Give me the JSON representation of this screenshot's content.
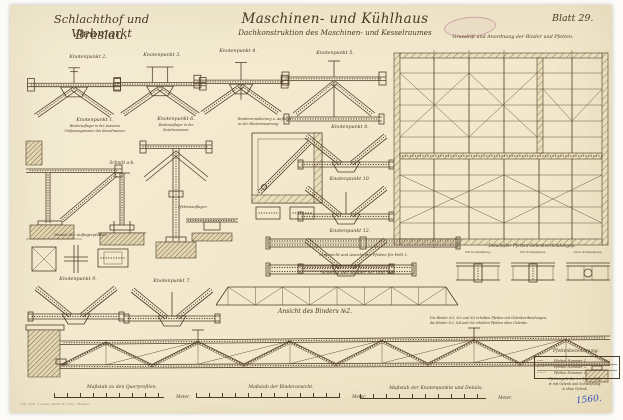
{
  "sheet": {
    "project_line1": "Schlachthof und Viehmarkt",
    "project_line2": "Breslau.",
    "title_line1": "Maschinen- und Kühlhaus",
    "subtitle": "Dachkonstruktion des Maschinen- und Kesselraumes",
    "blatt_label": "Blatt 29.",
    "archive_number": "1560.",
    "printer_note": "Lith. Anst. v. Grass, Barth & Comp., Breslau.",
    "ink_color": "#4f3c27",
    "paper_color": "#f2e8cc"
  },
  "plan": {
    "title": "Grundriß und Anordnung der Binder und Pfetten."
  },
  "details": {
    "k1": "Knotenpunkt 1.",
    "k1_sub1": "Binderauflager in der äusseren",
    "k1_sub2": "Umfassungsmauer des Kesselraumes.",
    "k2": "Knotenpunkt 2.",
    "k3": "Knotenpunkt 3.",
    "k4": "Knotenpunkt 4.",
    "k5": "Knotenpunkt 5.",
    "k6": "Knotenpunkt 6.",
    "k6_sub1": "Binderauflager in der",
    "k6_sub2": "Zwischenmauer.",
    "k7": "Knotenpunkt 7.",
    "k8": "Knotenpunkt 8.",
    "k9": "Knotenpunkt 9.",
    "k10": "Knotenpunkt 10.",
    "k12": "Knotenpunkt 12.",
    "schnitt_ab": "Schnitt a-b.",
    "pfettenauflager": "Pfettenauflager:",
    "verankerung1": "Binderverankerung u. Auflager",
    "verankerung2": "in der Hintermauerung:",
    "auflagerplatten": "Details der Auflagerplatten.",
    "untersicht_pfette": "Untersicht und Ansicht der Pfetten für Feld 2.",
    "gelenke_title": "Details der Pfetten-Gelenkverbindungen:",
    "gelenk1": "mit Schweißung.",
    "gelenk2": "mit Schweißung.",
    "gelenk3": "ohne Schweißung.",
    "schema_title": "Schema der Binder №1 und №2.",
    "ansicht_title": "Ansicht des Binders №2."
  },
  "notes": {
    "binder_note1": "Die Binder №1, №3 und №5 erhalten Pfetten mit Gelenkverbindungen,",
    "binder_note2": "die Binder №2, №4 und №6 erhalten Pfetten ohne Gelenke."
  },
  "legend": {
    "title": "Pfettenbezeichnung:",
    "rows": [
      {
        "sym": "───",
        "label": "Pfetten Nummer 1."
      },
      {
        "sym": "─ · ─",
        "label": "Pfetten Nummer 2."
      },
      {
        "sym": "─ ─ ─",
        "label": "Pfetten Nummer 3."
      }
    ],
    "note_title": "Pfettengelenke im Querschiff:",
    "note1": "⊕ mit Gelenk und Schweißung.",
    "note2": "⊖ ohne Gelenk."
  },
  "scales": {
    "s1_label": "Maßstab zu den Querprofilen.",
    "s2_label": "Maßstab der Binderansicht.",
    "s3_label": "Maßstab der Knotenpunkte und Details.",
    "unit": "Meter."
  }
}
